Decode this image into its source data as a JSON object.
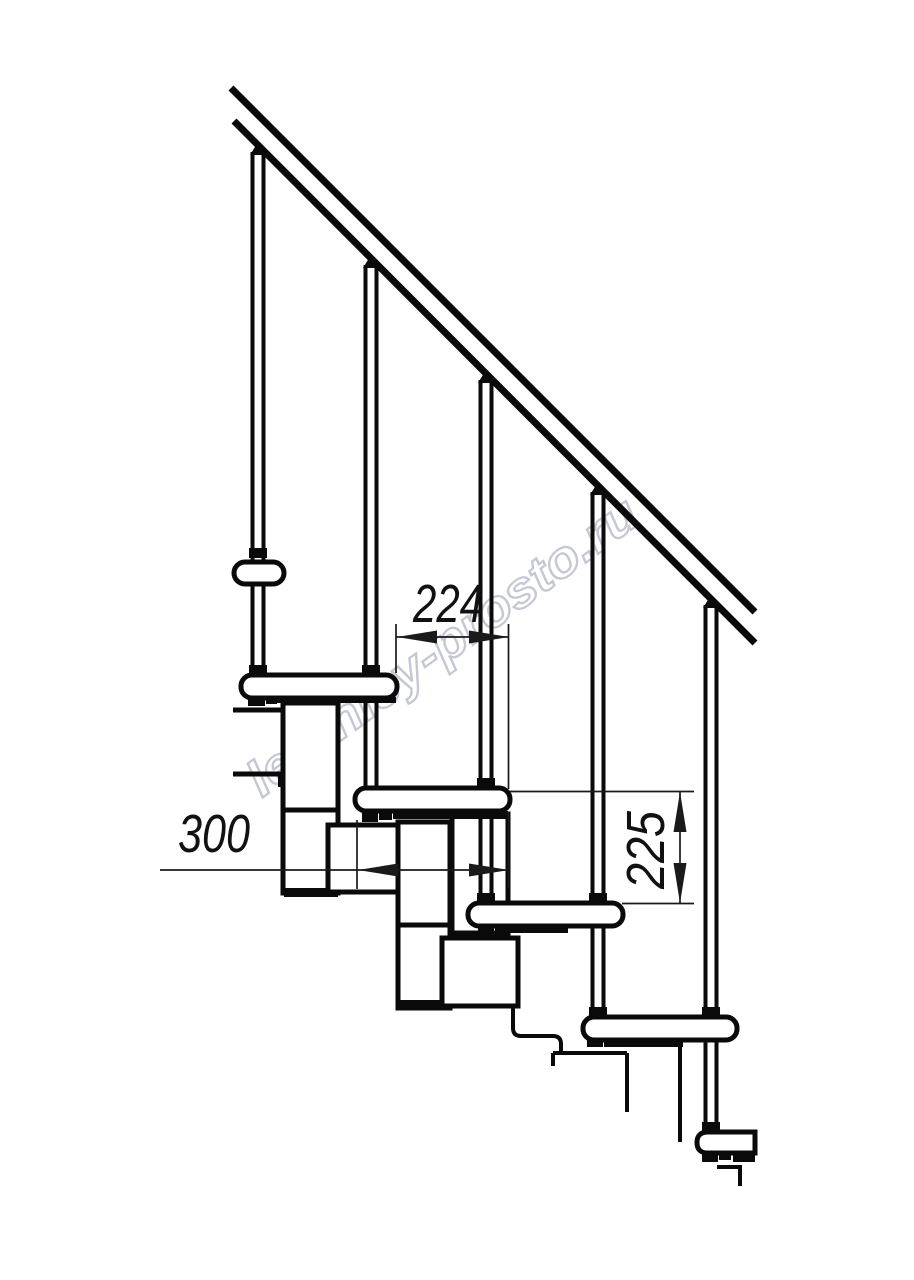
{
  "drawing": {
    "watermark": "lestnicy-prosto.ru",
    "dimensions": {
      "going": "224",
      "tread_depth": "300",
      "rise": "225"
    },
    "colors": {
      "line": "#0a0a0a",
      "dimension_line": "#1a1a1a",
      "watermark_outline": "#c5c8d4",
      "background": "#ffffff"
    }
  }
}
